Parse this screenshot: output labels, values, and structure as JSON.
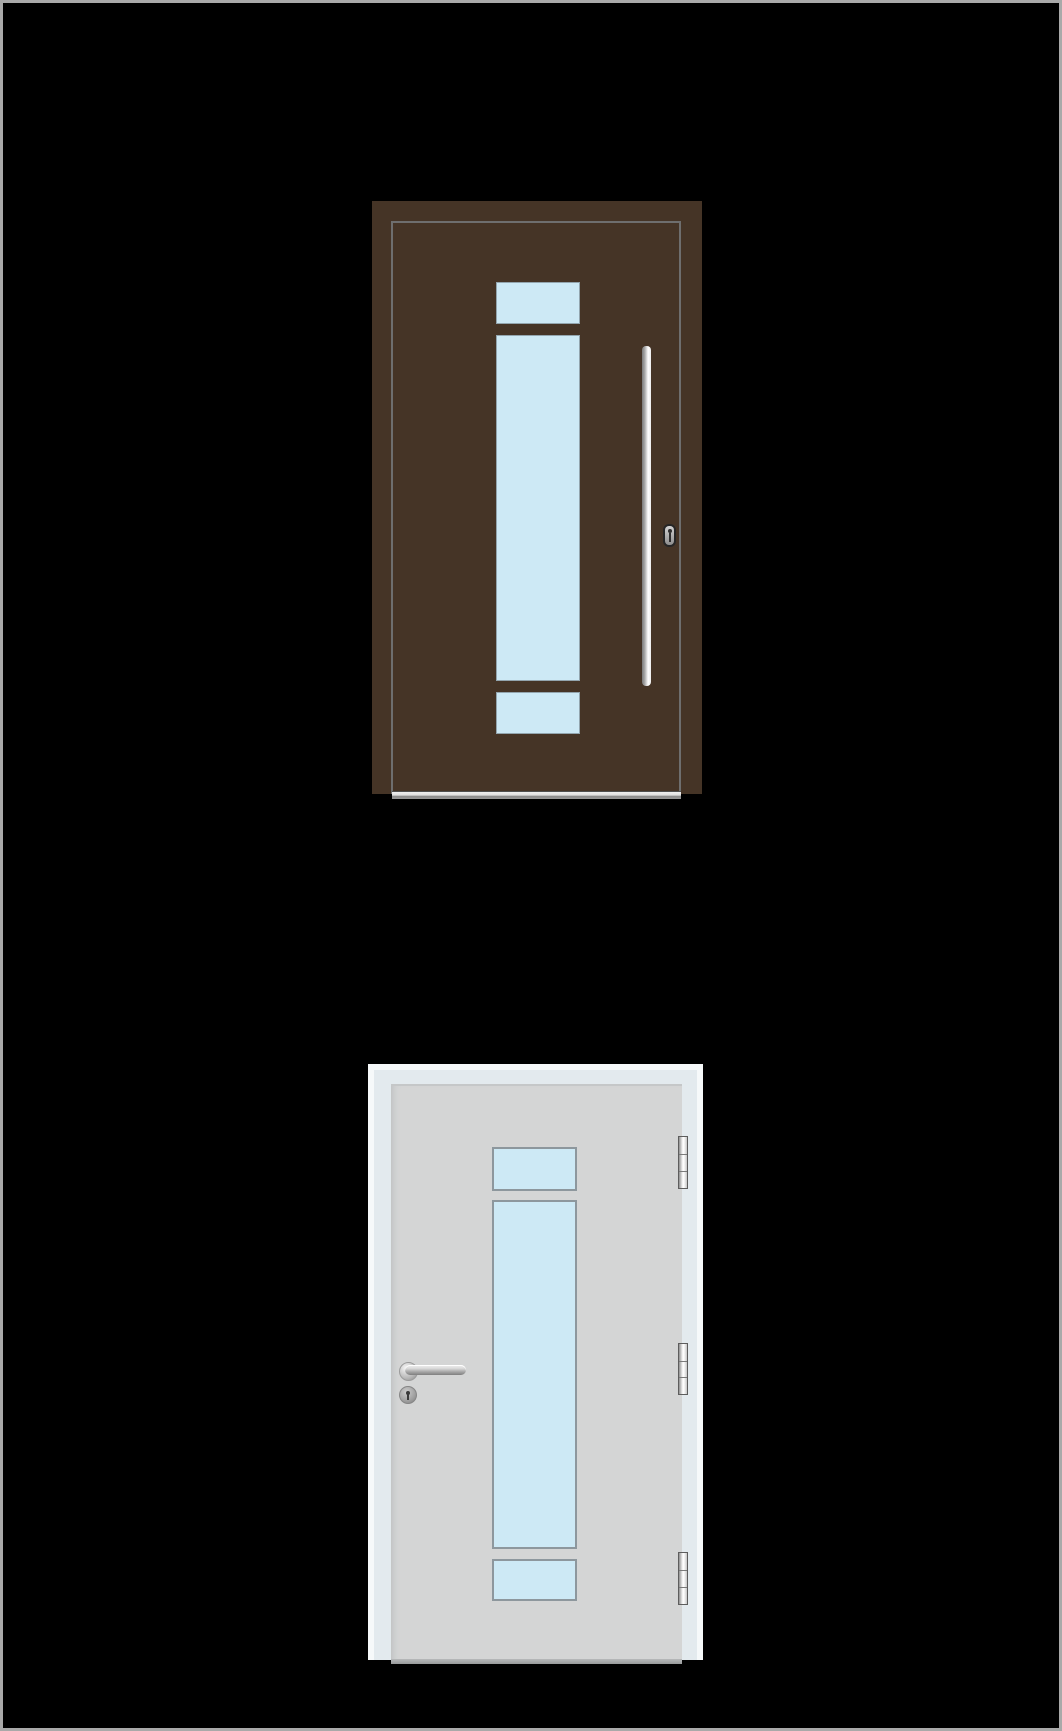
{
  "scene": {
    "background": "#000000",
    "border": "#a9a9a9",
    "description": "two-door-product-views"
  },
  "colors": {
    "ext_panel": "#453426",
    "ext_leaf_edge": "#6e6e6e",
    "glass": "#cde9f5",
    "glass_border_ext": "#93a5ae",
    "glass_border_int": "#8d979d",
    "int_frame": "#e3eaee",
    "int_frame_hi": "#f6f9fa",
    "int_panel": "#d4d5d5",
    "metal_light": "#ffffff",
    "metal_dark": "#7a7a7a"
  },
  "exterior_door": {
    "view": "exterior-brown-door",
    "panel_color": "#453426",
    "glazing_panels": [
      {
        "x": 493,
        "y": 279,
        "w": 84,
        "h": 42
      },
      {
        "x": 493,
        "y": 332,
        "w": 84,
        "h": 346
      },
      {
        "x": 493,
        "y": 689,
        "w": 84,
        "h": 42
      }
    ],
    "hardware": [
      "pull-bar-handle",
      "lock-cylinder",
      "threshold-sill"
    ]
  },
  "interior_door": {
    "view": "interior-white-door",
    "panel_color": "#d4d5d5",
    "glazing_panels": [
      {
        "x": 489,
        "y": 1144,
        "w": 85,
        "h": 44
      },
      {
        "x": 489,
        "y": 1197,
        "w": 85,
        "h": 349
      },
      {
        "x": 489,
        "y": 1556,
        "w": 85,
        "h": 42
      }
    ],
    "hinges": [
      {
        "x": 675,
        "y": 1133,
        "w": 10,
        "h": 53
      },
      {
        "x": 675,
        "y": 1340,
        "w": 10,
        "h": 52
      },
      {
        "x": 675,
        "y": 1549,
        "w": 10,
        "h": 53
      }
    ],
    "hardware": [
      "lever-handle",
      "keyhole-escutcheon",
      "hinge",
      "hinge",
      "hinge"
    ]
  }
}
